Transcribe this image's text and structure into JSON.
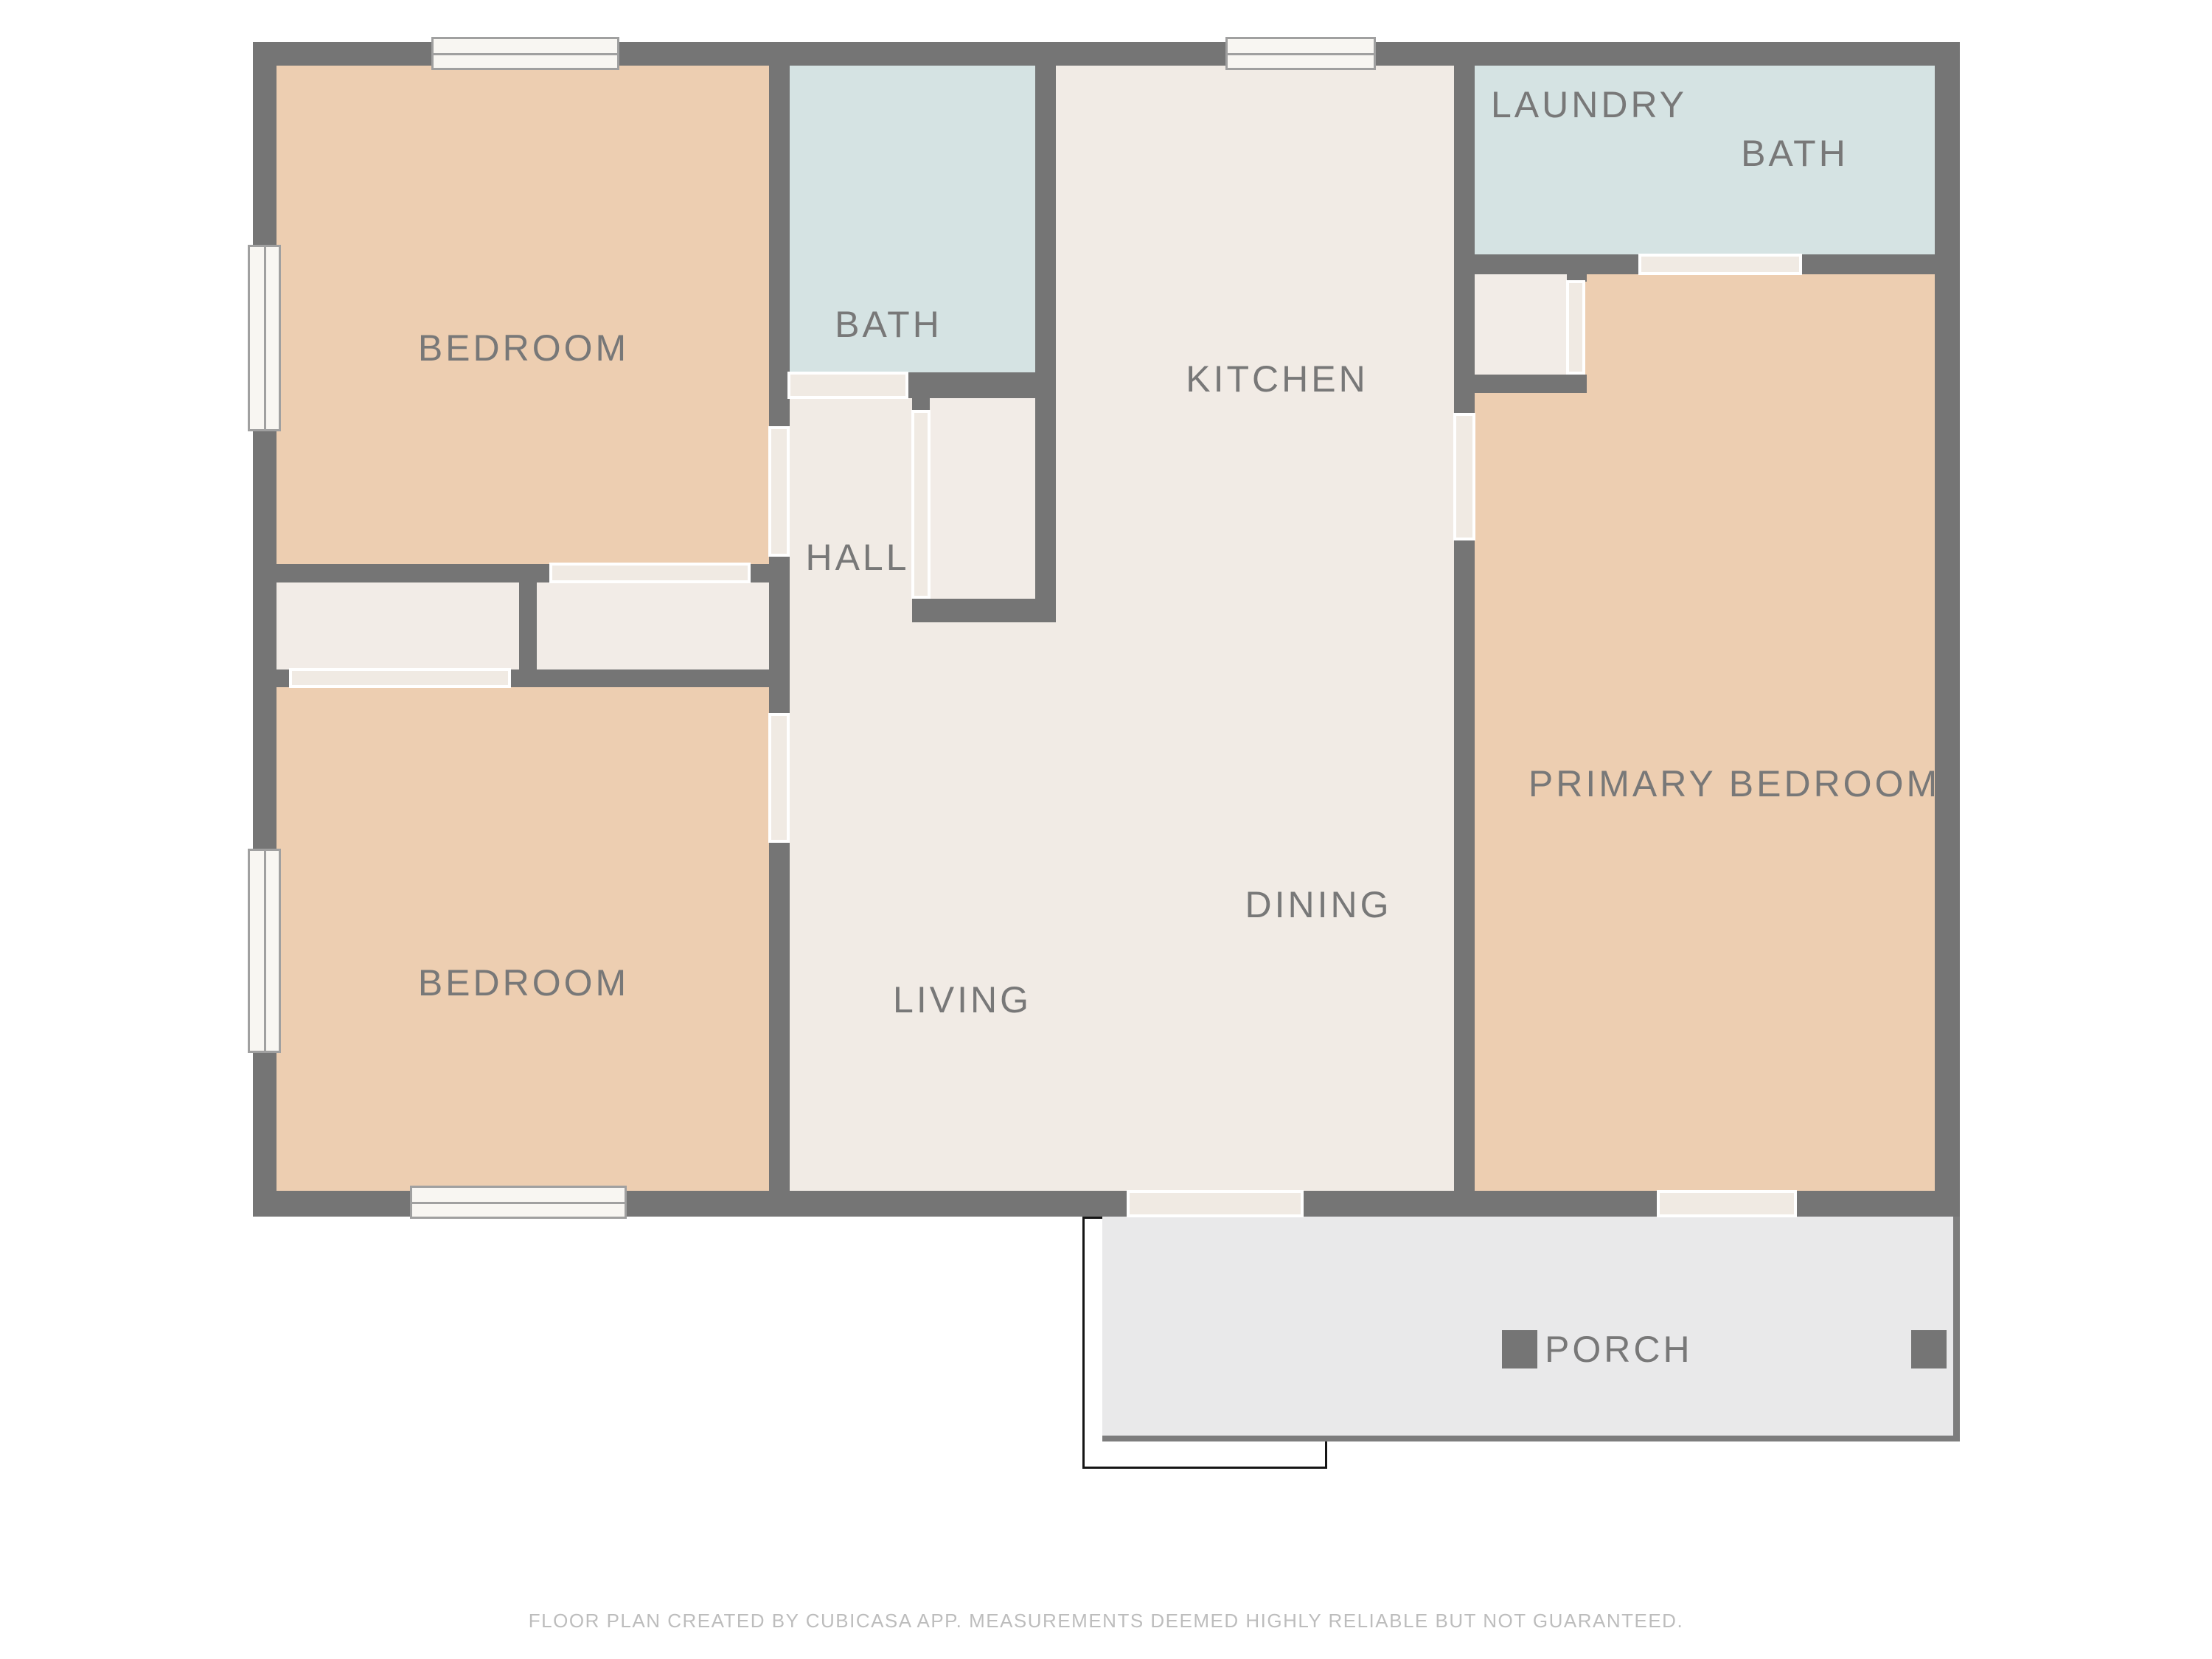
{
  "rooms": {
    "bedroom_top": {
      "label": "BEDROOM"
    },
    "bath_main": {
      "label": "BATH"
    },
    "kitchen": {
      "label": "KITCHEN"
    },
    "laundry": {
      "label": "LAUNDRY"
    },
    "bath_laundry": {
      "label": "BATH"
    },
    "hall": {
      "label": "HALL"
    },
    "primary_bedroom": {
      "label": "PRIMARY BEDROOM"
    },
    "dining": {
      "label": "DINING"
    },
    "living": {
      "label": "LIVING"
    },
    "bedroom_bottom": {
      "label": "BEDROOM"
    },
    "porch": {
      "label": "PORCH"
    }
  },
  "footer": {
    "text": "FLOOR PLAN CREATED BY CUBICASA APP. MEASUREMENTS DEEMED HIGHLY RELIABLE BUT NOT GUARANTEED."
  },
  "colors": {
    "bg": "#ffffff",
    "wall": "#757575",
    "peach": "#edceb1",
    "blue": "#d5e3e3",
    "cream": "#f1ebe5",
    "closet": "#f2ece7",
    "porch": "#e9e9ea",
    "porch_border": "#7d7d7d",
    "door": "#f0eae3",
    "window_fill": "#f8f6f2",
    "window_frame": "#a0a0a0",
    "label": "#787878",
    "footer": "#bdbdbd",
    "step": "#151515",
    "post": "#757575"
  }
}
